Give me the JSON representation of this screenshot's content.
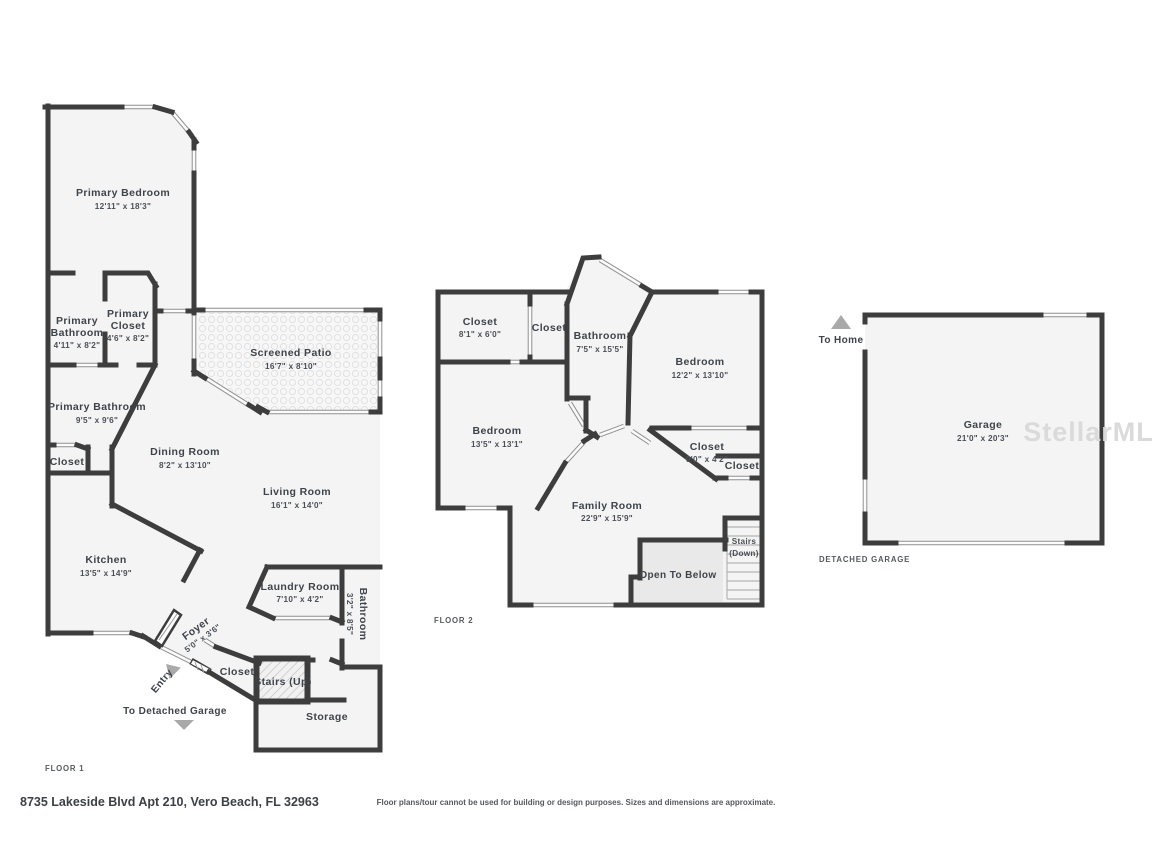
{
  "colors": {
    "wall": "#3d3d3d",
    "room_fill": "#f4f4f4",
    "open_below_fill": "#e9e9e9",
    "window_line": "#8f8f8f",
    "label_text": "#3e444b",
    "arrow": "#a9a9a9",
    "watermark": "#dadada"
  },
  "floor1": {
    "label": "FLOOR 1",
    "rooms": [
      {
        "name": "Primary Bedroom",
        "dims": "12'11\" x 18'3\""
      },
      {
        "name_lines": [
          "Primary",
          "Bathroom"
        ],
        "dims": "4'11\" x 8'2\""
      },
      {
        "name_lines": [
          "Primary",
          "Closet"
        ],
        "dims": "4'6\" x 8'2\""
      },
      {
        "name": "Screened Patio",
        "dims": "16'7\" x 8'10\""
      },
      {
        "name": "Primary Bathroom",
        "dims": "9'5\" x 9'6\""
      },
      {
        "name": "Closet"
      },
      {
        "name": "Dining Room",
        "dims": "8'2\" x 13'10\""
      },
      {
        "name": "Living Room",
        "dims": "16'1\" x 14'0\""
      },
      {
        "name": "Kitchen",
        "dims": "13'5\" x 14'9\""
      },
      {
        "name": "Laundry Room",
        "dims": "7'10\" x 4'2\""
      },
      {
        "name": "Bathroom",
        "dims": "3'2\" x 8'5\""
      },
      {
        "name": "Foyer",
        "dims": "5'0\" x 3'6\""
      },
      {
        "name": "Closet"
      },
      {
        "name": "Stairs (Up)"
      },
      {
        "name": "Storage"
      }
    ],
    "annotations": {
      "entry": "Entry",
      "to_detached_garage": "To Detached Garage"
    }
  },
  "floor2": {
    "label": "FLOOR 2",
    "rooms": [
      {
        "name": "Closet",
        "dims": "8'1\" x 6'0\""
      },
      {
        "name": "Closet"
      },
      {
        "name": "Bathroom",
        "dims": "7'5\" x 15'5\""
      },
      {
        "name": "Bedroom",
        "dims": "12'2\" x 13'10\""
      },
      {
        "name": "Bedroom",
        "dims": "13'5\" x 13'1\""
      },
      {
        "name": "Closet",
        "dims": "9'0\" x 4'2\""
      },
      {
        "name": "Closet"
      },
      {
        "name": "Family Room",
        "dims": "22'9\" x 15'9\""
      },
      {
        "name_lines": [
          "Stairs",
          "(Down)"
        ]
      },
      {
        "name": "Open To Below"
      }
    ]
  },
  "garage": {
    "label": "DETACHED GARAGE",
    "room": {
      "name": "Garage",
      "dims": "21'0\" x 20'3\""
    },
    "annotations": {
      "to_home": "To Home"
    }
  },
  "footer": {
    "address": "8735 Lakeside Blvd Apt 210, Vero Beach, FL 32963",
    "disclaimer": "Floor plans/tour cannot be used for building or design purposes. Sizes and dimensions are approximate."
  },
  "watermark": {
    "text": "StellarMLS"
  }
}
